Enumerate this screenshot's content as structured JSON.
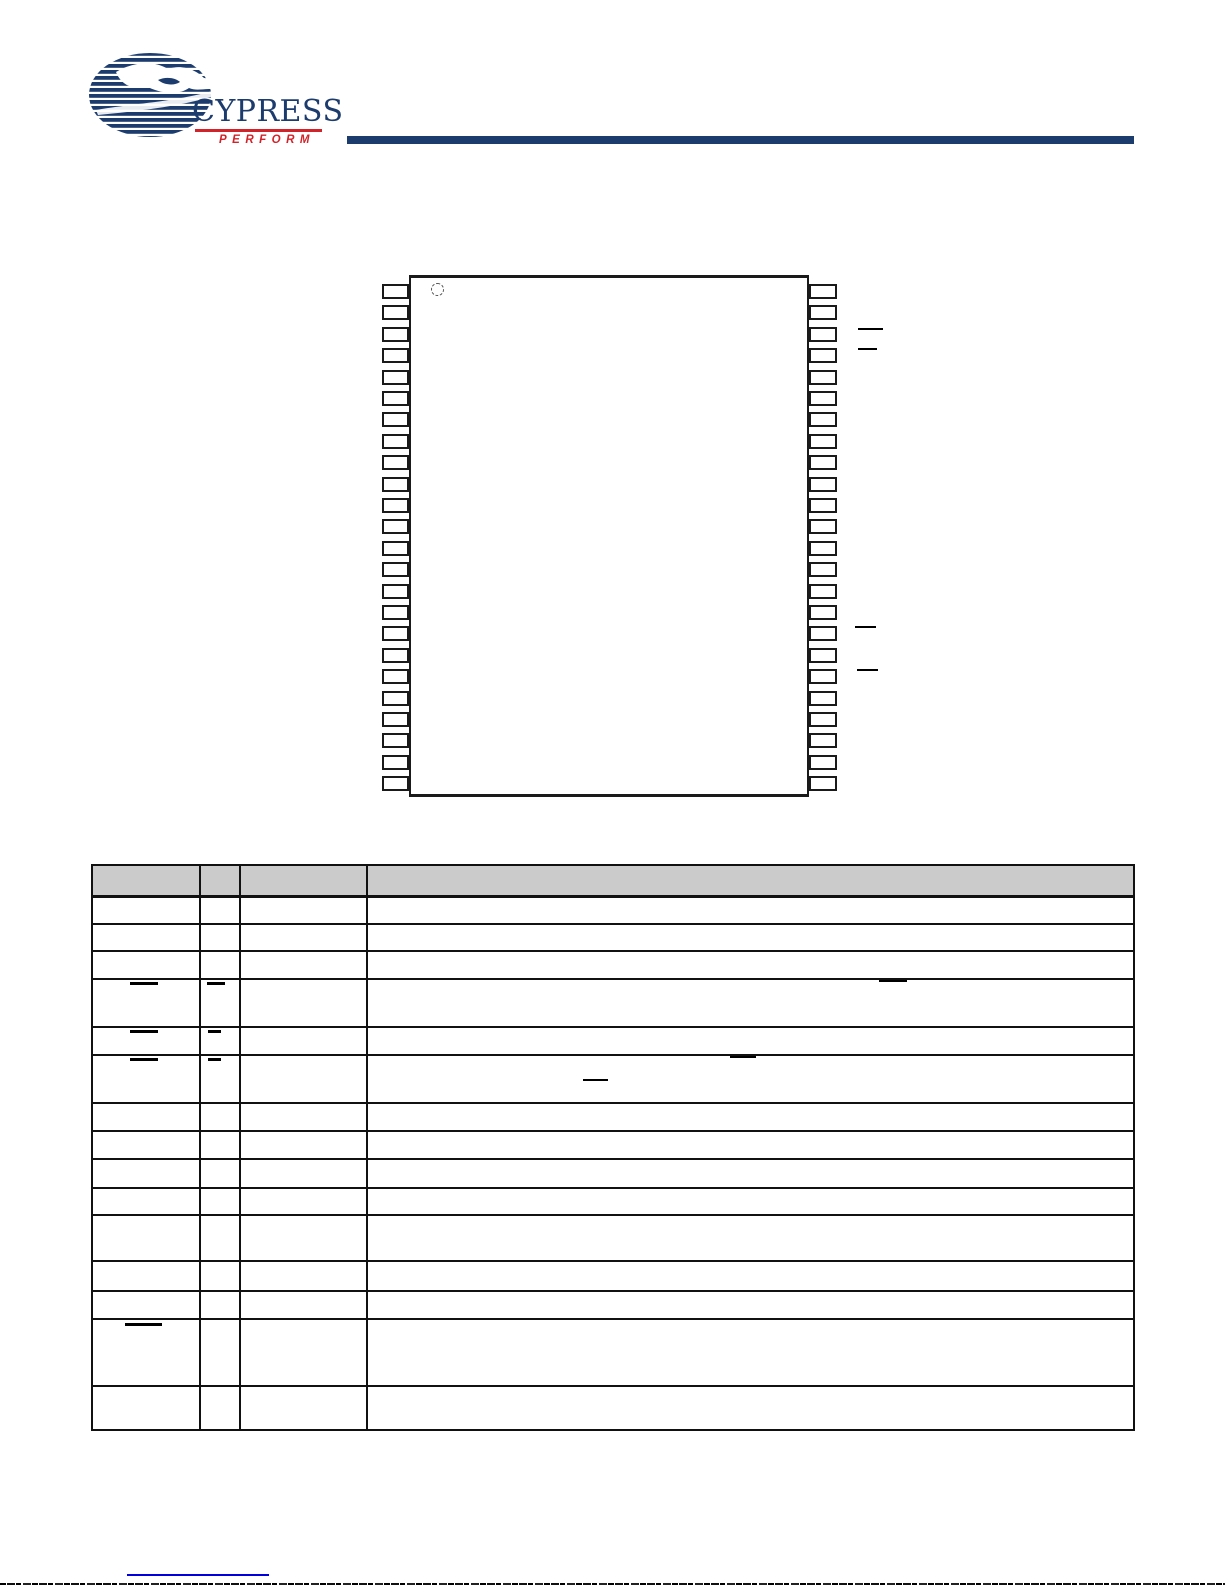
{
  "page": {
    "width": 1225,
    "height": 1585,
    "background": "#ffffff"
  },
  "logo": {
    "brand": "CYPRESS",
    "tagline": "PERFORM",
    "navy": "#1d3c6e",
    "red": "#d2232a"
  },
  "header_rule": {
    "x": 347,
    "y": 136,
    "width": 787,
    "height": 8,
    "color": "#1d3c6e"
  },
  "pin_diagram": {
    "package": {
      "x": 409,
      "y": 275,
      "width": 400,
      "height": 522
    },
    "pin1_circle": {
      "x": 431,
      "y": 283,
      "d": 11
    },
    "pins_per_side": 24,
    "pin": {
      "width": 27,
      "height": 15,
      "pitch": 21.4,
      "first_top": 284
    },
    "left_pin_x": 382,
    "right_pin_x": 809,
    "right_overbars": [
      {
        "x": 858,
        "y": 328,
        "w": 25,
        "h": 2
      },
      {
        "x": 858,
        "y": 348,
        "w": 19,
        "h": 2
      },
      {
        "x": 855,
        "y": 626,
        "w": 21,
        "h": 2
      },
      {
        "x": 857,
        "y": 669,
        "w": 21,
        "h": 2
      }
    ]
  },
  "pin_table": {
    "x": 91,
    "y": 864,
    "width": 1044,
    "height": 567,
    "header_height": 29,
    "header_fill": "#cbcbcb",
    "column_offsets": [
      106,
      146,
      273
    ],
    "row_heights": [
      28,
      27,
      28,
      48,
      28,
      48,
      28,
      28,
      29,
      27,
      46,
      30,
      28,
      67,
      48
    ],
    "overbar_marks": [
      {
        "x": 130,
        "y": 982,
        "w": 28,
        "h": 3
      },
      {
        "x": 207,
        "y": 982,
        "w": 18,
        "h": 3
      },
      {
        "x": 879,
        "y": 980,
        "w": 28,
        "h": 2
      },
      {
        "x": 130,
        "y": 1030,
        "w": 28,
        "h": 3
      },
      {
        "x": 208,
        "y": 1030,
        "w": 13,
        "h": 3
      },
      {
        "x": 130,
        "y": 1058,
        "w": 28,
        "h": 3
      },
      {
        "x": 208,
        "y": 1058,
        "w": 13,
        "h": 3
      },
      {
        "x": 730,
        "y": 1056,
        "w": 26,
        "h": 2
      },
      {
        "x": 583,
        "y": 1079,
        "w": 25,
        "h": 2
      },
      {
        "x": 125,
        "y": 1323,
        "w": 37,
        "h": 3
      }
    ]
  },
  "footer": {
    "link_underline": {
      "x": 127,
      "y": 1574,
      "width": 142,
      "height": 2,
      "color": "#0000dd"
    }
  }
}
